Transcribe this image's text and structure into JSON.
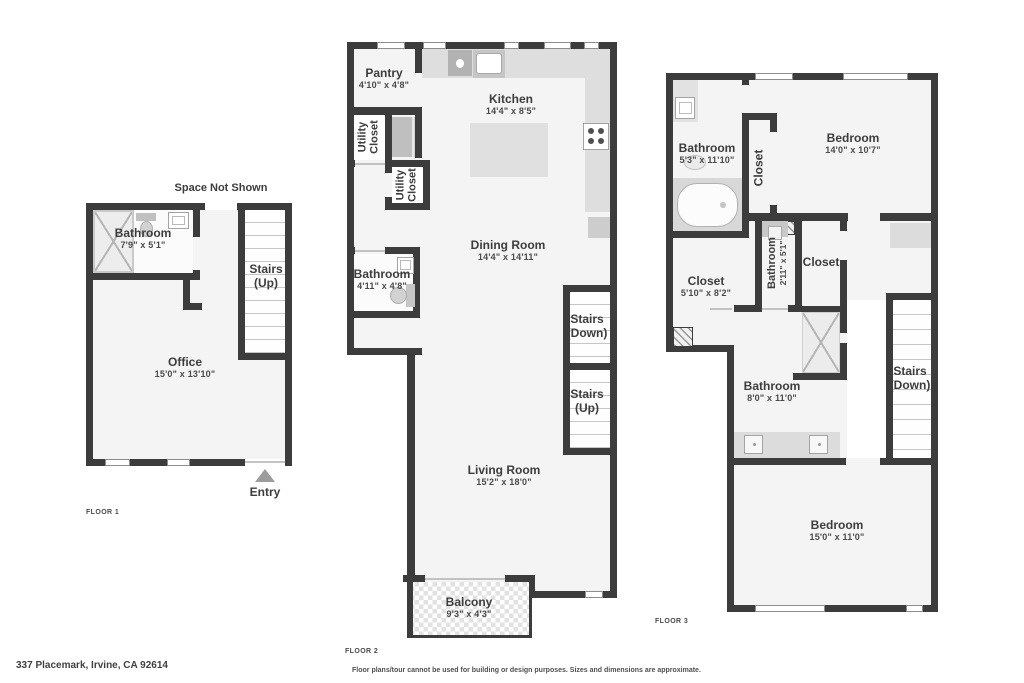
{
  "colors": {
    "wall": "#3c3c3c",
    "floor_fill": "#f4f4f4",
    "fixture": "#dedede",
    "text": "#3d3d3d"
  },
  "floor1": {
    "tag": "FLOOR 1",
    "space_not_shown": "Space Not Shown",
    "entry": "Entry",
    "rooms": {
      "bathroom": {
        "name": "Bathroom",
        "dims": "7'9\" x 5'1\""
      },
      "office": {
        "name": "Office",
        "dims": "15'0\" x 13'10\""
      },
      "stairs": {
        "name": "Stairs",
        "dir": "(Up)"
      }
    }
  },
  "floor2": {
    "tag": "FLOOR 2",
    "rooms": {
      "pantry": {
        "name": "Pantry",
        "dims": "4'10\" x 4'8\""
      },
      "kitchen": {
        "name": "Kitchen",
        "dims": "14'4\" x 8'5\""
      },
      "utility_closet_1": {
        "name": "Utility Closet"
      },
      "utility_closet_2": {
        "name": "Utility Closet"
      },
      "bathroom": {
        "name": "Bathroom",
        "dims": "4'11\" x 4'8\""
      },
      "dining_room": {
        "name": "Dining Room",
        "dims": "14'4\" x 14'11\""
      },
      "stairs_down": {
        "name": "Stairs",
        "dir": "(Down)"
      },
      "stairs_up": {
        "name": "Stairs",
        "dir": "(Up)"
      },
      "living_room": {
        "name": "Living Room",
        "dims": "15'2\" x 18'0\""
      },
      "balcony": {
        "name": "Balcony",
        "dims": "9'3\" x 4'3\""
      }
    }
  },
  "floor3": {
    "tag": "FLOOR 3",
    "rooms": {
      "bathroom_upper": {
        "name": "Bathroom",
        "dims": "5'3\" x 11'10\""
      },
      "closet_upper": {
        "name": "Closet"
      },
      "bedroom_upper": {
        "name": "Bedroom",
        "dims": "14'0\" x 10'7\""
      },
      "closet_left": {
        "name": "Closet",
        "dims": "5'10\" x 8'2\""
      },
      "bathroom_middle": {
        "name": "Bathroom",
        "dims": "2'11\" x 5'1\""
      },
      "closet_right": {
        "name": "Closet"
      },
      "bathroom_lower": {
        "name": "Bathroom",
        "dims": "8'0\" x 11'0\""
      },
      "stairs_down": {
        "name": "Stairs",
        "dir": "(Down)"
      },
      "bedroom_lower": {
        "name": "Bedroom",
        "dims": "15'0\" x 11'0\""
      }
    }
  },
  "footer": {
    "address": "337 Placemark, Irvine, CA 92614",
    "disclaimer": "Floor plans/tour cannot be used for building or design purposes. Sizes and dimensions are approximate."
  }
}
